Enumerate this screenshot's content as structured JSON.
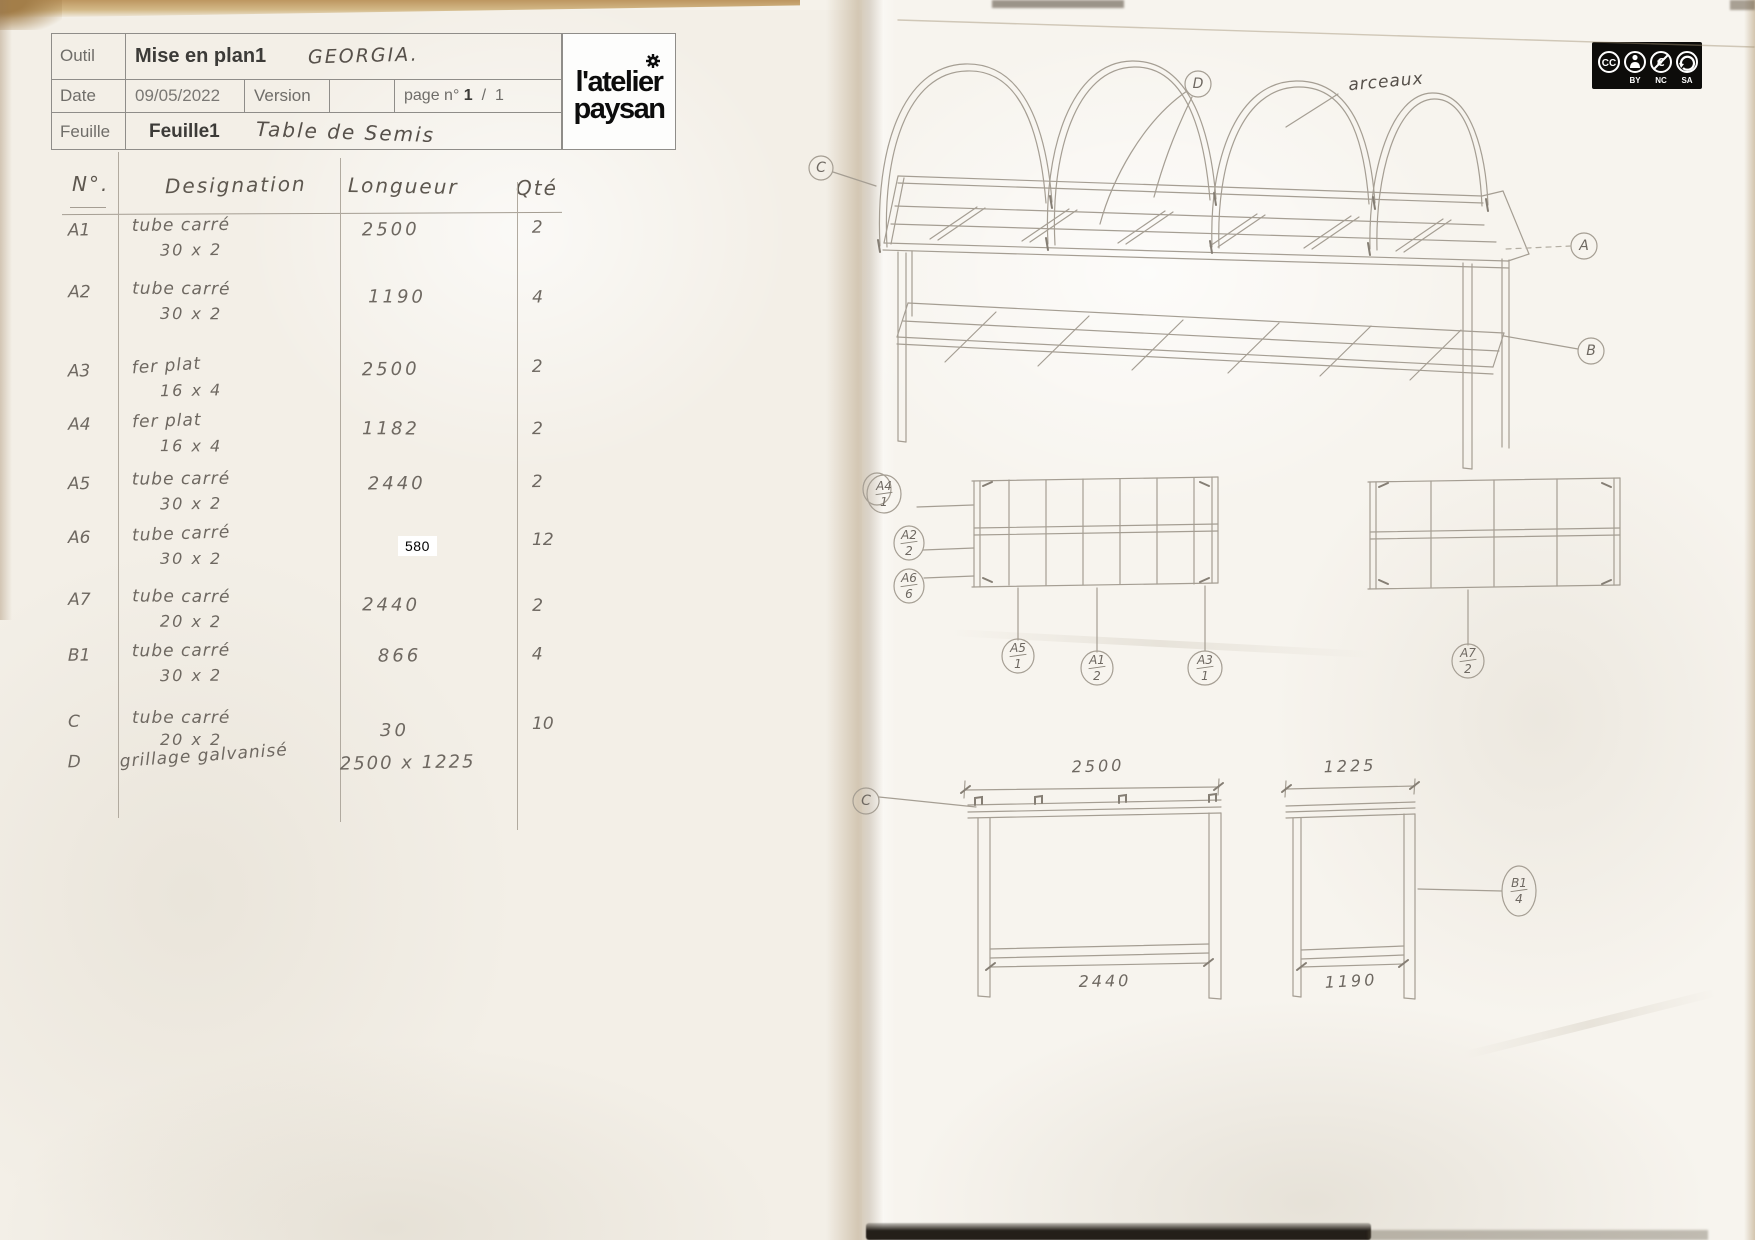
{
  "title_block": {
    "outil_label": "Outil",
    "outil_value": "Mise en plan1",
    "outil_handwritten": "GEORGIA.",
    "date_label": "Date",
    "date_value": "09/05/2022",
    "version_label": "Version",
    "version_value": "",
    "page_label": "page n°",
    "page_num": "1",
    "page_sep": "/",
    "page_total": "1",
    "feuille_label": "Feuille",
    "feuille_value": "Feuille1",
    "feuille_handwritten": "Table de Semis",
    "logo_line1": "l'atelier",
    "logo_line2": "paysan"
  },
  "license_badge": {
    "cc": "CC",
    "by_label": "BY",
    "nc_label": "NC",
    "sa_label": "SA"
  },
  "parts_table": {
    "headers": {
      "num": "N°.",
      "designation": "Designation",
      "longueur": "Longueur",
      "qte": "Qté"
    },
    "rows": [
      {
        "num": "A1",
        "designation": "tube carré",
        "size": "30 x 2",
        "longueur": "2500",
        "qte": "2"
      },
      {
        "num": "A2",
        "designation": "tube carré",
        "size": "30 x 2",
        "longueur": "1190",
        "qte": "4"
      },
      {
        "num": "A3",
        "designation": "fer plat",
        "size": "16 x 4",
        "longueur": "2500",
        "qte": "2"
      },
      {
        "num": "A4",
        "designation": "fer plat",
        "size": "16 x 4",
        "longueur": "1182",
        "qte": "2"
      },
      {
        "num": "A5",
        "designation": "tube carré",
        "size": "30 x 2",
        "longueur": "2440",
        "qte": "2"
      },
      {
        "num": "A6",
        "designation": "tube carré",
        "size": "30 x 2",
        "longueur": "580",
        "qte": "12"
      },
      {
        "num": "A7",
        "designation": "tube carré",
        "size": "20 x 2",
        "longueur": "2440",
        "qte": "2"
      },
      {
        "num": "B1",
        "designation": "tube carré",
        "size": "30 x 2",
        "longueur": "866",
        "qte": "4"
      },
      {
        "num": "C",
        "designation": "tube carré",
        "size": "20 x 2",
        "longueur": "30",
        "qte": "10"
      },
      {
        "num": "D",
        "designation": "grillage galvanisé",
        "size": "",
        "longueur": "2500 x 1225",
        "qte": ""
      }
    ]
  },
  "drawing": {
    "arceaux_label": "arceaux",
    "iso_balloons": {
      "a": "A",
      "b": "B",
      "c": "C",
      "d": "D"
    },
    "panel_balloons": {
      "left_stack": [
        {
          "part": "A4",
          "qty": "1"
        },
        {
          "part": "A2",
          "qty": "2"
        },
        {
          "part": "A6",
          "qty": "6"
        }
      ],
      "below": [
        {
          "part": "A5",
          "qty": "1"
        },
        {
          "part": "A1",
          "qty": "2"
        },
        {
          "part": "A3",
          "qty": "1"
        },
        {
          "part": "A7",
          "qty": "2"
        }
      ],
      "bottom_right": {
        "part": "B1",
        "qty": "4"
      },
      "bottom_left": "C"
    },
    "dimensions": {
      "front_width_top": "2500",
      "front_width_bottom": "2440",
      "side_depth_top": "1225",
      "side_depth_bottom": "1190"
    }
  }
}
